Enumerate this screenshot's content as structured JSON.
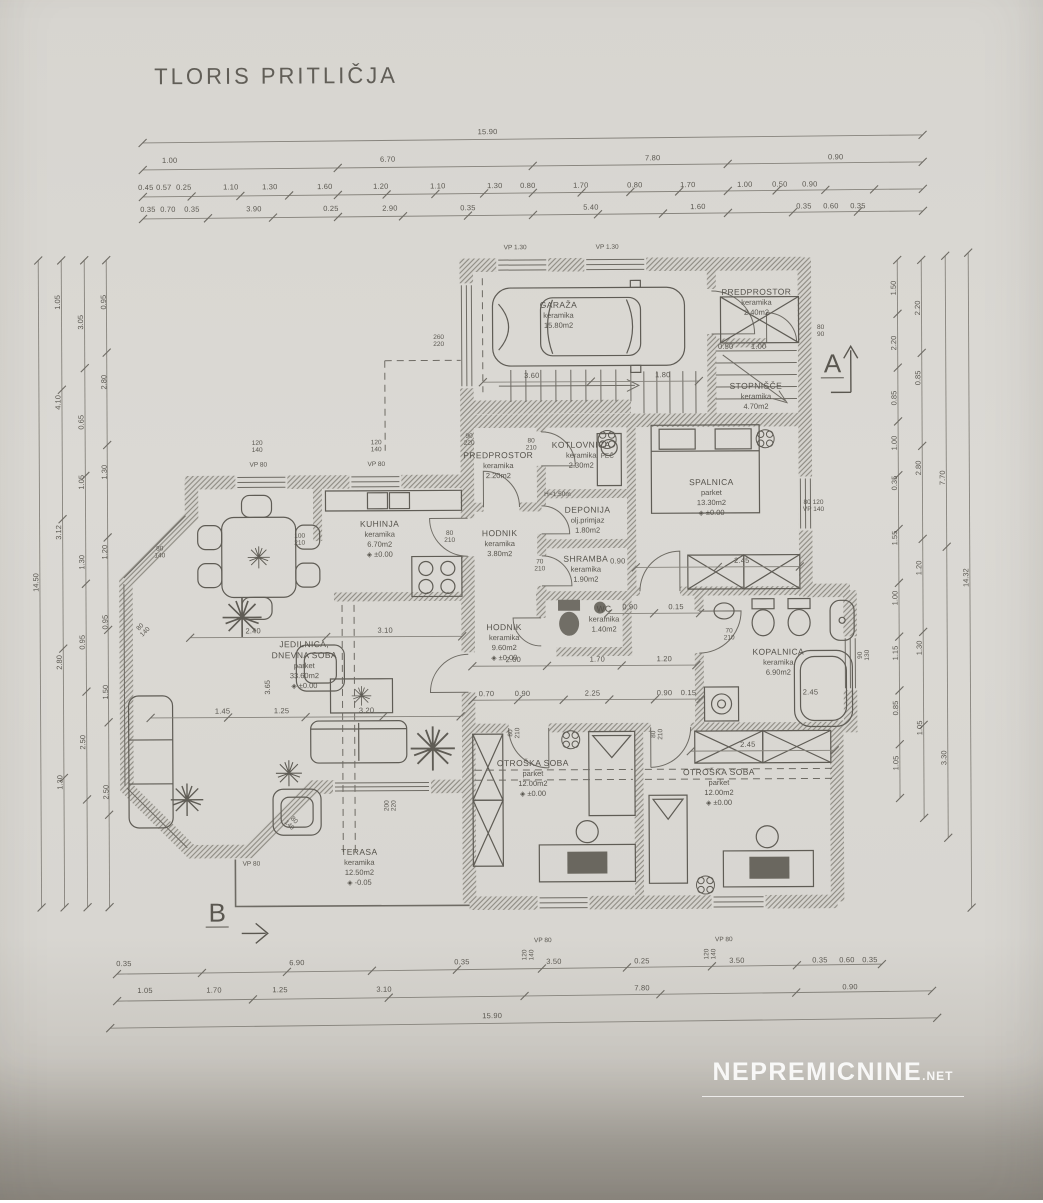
{
  "title": "TLORIS PRITLIČJA",
  "watermark": {
    "brand": "NEPREMICNINE",
    "tld": ".NET"
  },
  "sections": {
    "a": "A",
    "b": "B"
  },
  "rooms": [
    {
      "name": "GARAŽA",
      "material": "keramika",
      "area": "15.80m2"
    },
    {
      "name": "PREDPROSTOR",
      "material": "keramika",
      "area": "2.40m2"
    },
    {
      "name": "STOPNIŠČE",
      "material": "keramika",
      "area": "4.70m2"
    },
    {
      "name": "KOTLOVNICA",
      "material": "keramika",
      "area": "2.30m2"
    },
    {
      "name": "PREDPROSTOR",
      "material": "keramika",
      "area": "2.20m2"
    },
    {
      "name": "SPALNICA",
      "material": "parket",
      "area": "13.30m2",
      "level": "±0.00"
    },
    {
      "name": "KUHINJA",
      "material": "keramika",
      "area": "6.70m2",
      "level": "±0.00"
    },
    {
      "name": "HODNIK",
      "material": "keramika",
      "area": "3.80m2"
    },
    {
      "name": "DEPONIJA",
      "material": "olj.primjaz",
      "area": "1.80m2"
    },
    {
      "name": "SHRAMBA",
      "material": "keramika",
      "area": "1.90m2"
    },
    {
      "name": "WC",
      "material": "keramika",
      "area": "1.40m2"
    },
    {
      "name": "HODNIK",
      "material": "keramika",
      "area": "9.60m2",
      "level": "±0.00"
    },
    {
      "name": "KOPALNICA",
      "material": "keramika",
      "area": "6.90m2"
    },
    {
      "name": "JEDILNICA,\nDNEVNA SOBA",
      "material": "parket",
      "area": "33.60m2",
      "level": "±0.00"
    },
    {
      "name": "OTROŠKA SOBA",
      "material": "parket",
      "area": "12.00m2",
      "level": "±0.00"
    },
    {
      "name": "OTROŠKA SOBA",
      "material": "parket",
      "area": "12.00m2",
      "level": "±0.00"
    },
    {
      "name": "TERASA",
      "material": "keramika",
      "area": "12.50m2",
      "level": "-0.05"
    }
  ],
  "ann": [
    "VP 1.30",
    "VP 1.30",
    "260\n220",
    "120\n140",
    "VP 80",
    "120\n140",
    "VP 80",
    "90\n220",
    "80\n210",
    "PEČ",
    "H=1.50m",
    "100\n210",
    "80\n210",
    "70\n210",
    "70\n210",
    "80\n140",
    "80\n140",
    "80\n140",
    "200\n220",
    "VP 80",
    "VP 80",
    "VP 80",
    "80\n210",
    "80\n210",
    "80\n90",
    "80 120\nVP 140",
    "120\n140",
    "120\n140",
    "90\n130"
  ],
  "dims": {
    "top": [
      [
        "15.90"
      ],
      [
        "1.00",
        "6.70",
        "7.80",
        "0.90"
      ],
      [
        "0.45",
        "0.57",
        "0.25",
        "1.10",
        "1.30",
        "1.60",
        "1.20",
        "1.10",
        "1.30",
        "0.80",
        "1.70",
        "0.80",
        "1.70",
        "1.00",
        "0.50",
        "0.90"
      ],
      [
        "0.35",
        "0.70",
        "0.35",
        "3.90",
        "0.25",
        "2.90",
        "0.35",
        "5.40",
        "1.60",
        "0.35",
        "0.60",
        "0.35"
      ]
    ],
    "bottom": [
      [
        "0.35",
        "6.90",
        "0.35",
        "3.50",
        "0.25",
        "3.50",
        "0.35",
        "0.60",
        "0.35"
      ],
      [
        "1.05",
        "1.70",
        "1.25",
        "3.10",
        "7.80",
        "0.90"
      ],
      [
        "15.90"
      ]
    ],
    "left": [
      [
        "14.50"
      ],
      [
        "1.05",
        "4.10",
        "3.12",
        "2.80",
        "1.30"
      ],
      [
        "3.05",
        "0.65",
        "1.05",
        "1.30",
        "0.95",
        "2.50"
      ],
      [
        "0.95",
        "2.80",
        "1.30",
        "1.20",
        "0.95",
        "1.50",
        "2.50"
      ]
    ],
    "right": [
      [
        "14.32"
      ],
      [
        "7.70",
        "3.30"
      ],
      [
        "2.20",
        "0.85",
        "2.80",
        "1.20",
        "1.30",
        "1.05"
      ],
      [
        "1.50",
        "2.20",
        "0.85",
        "1.00",
        "0.35",
        "1.55",
        "1.00",
        "1.15",
        "0.85",
        "1.05"
      ]
    ],
    "inner": [
      "3.60",
      "1.80",
      "2.00",
      "1.70",
      "1.20",
      "0.70",
      "0.90",
      "2.25",
      "0.90",
      "0.15",
      "2.45",
      "0.90",
      "2.45",
      "3.10",
      "2.40",
      "1.45",
      "1.25",
      "3.20",
      "3.65",
      "2.45",
      "0.90",
      "0.15",
      "0.50",
      "1.00"
    ]
  }
}
